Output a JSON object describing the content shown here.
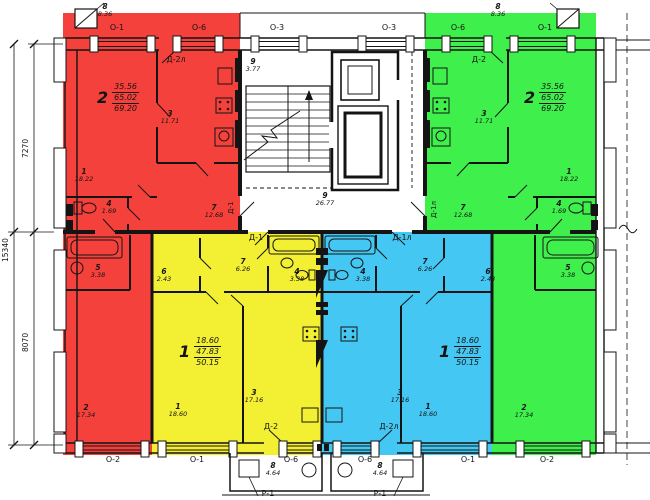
{
  "colors": {
    "red": "#f5413b",
    "green": "#3ff04c",
    "yellow": "#f3ef33",
    "blue": "#45c7f3"
  },
  "dimensions": {
    "height_total": "15340",
    "height_top": "7270",
    "height_bottom": "8070"
  },
  "windows_top": [
    "О-1",
    "О-6",
    "О-3",
    "О-3",
    "О-6",
    "О-1"
  ],
  "windows_bottom": [
    "О-2",
    "О-1",
    "О-6",
    "О-6",
    "О-1",
    "О-2"
  ],
  "doors": {
    "red_balcony": "Д-2л",
    "green_balcony": "Д-2",
    "red_entry": "Д-1",
    "green_entry": "Д-1л",
    "yellow_entry": "Д-1",
    "blue_entry": "Д-1л",
    "yellow_balcony": "Д-2",
    "blue_balcony": "Д-2л"
  },
  "porches": {
    "left": "Р-1",
    "right": "Р-1"
  },
  "balconies": {
    "top_left": {
      "num": "8",
      "area": "8.36"
    },
    "top_right": {
      "num": "8",
      "area": "8.36"
    },
    "bottom_left": {
      "num": "8",
      "area": "4.64"
    },
    "bottom_right": {
      "num": "8",
      "area": "4.64"
    }
  },
  "core": {
    "stair": {
      "num": "9",
      "area": "3.77"
    },
    "hall": {
      "num": "9",
      "area": "26.77"
    }
  },
  "apartments": {
    "red": {
      "unit": "2",
      "living": "35.56",
      "total": "65.02",
      "with_balcony": "69.20",
      "rooms": {
        "r1": {
          "num": "1",
          "area": "18.22"
        },
        "r3": {
          "num": "3",
          "area": "11.71"
        },
        "r4": {
          "num": "4",
          "area": "1.69"
        },
        "r5": {
          "num": "5",
          "area": "3.38"
        },
        "r7": {
          "num": "7",
          "area": "12.68"
        },
        "r2": {
          "num": "2",
          "area": "17.34"
        }
      }
    },
    "green": {
      "unit": "2",
      "living": "35.56",
      "total": "65.02",
      "with_balcony": "69.20",
      "rooms": {
        "r1": {
          "num": "1",
          "area": "18.22"
        },
        "r3": {
          "num": "3",
          "area": "11.71"
        },
        "r4": {
          "num": "4",
          "area": "1.69"
        },
        "r5": {
          "num": "5",
          "area": "3.38"
        },
        "r7": {
          "num": "7",
          "area": "12.68"
        },
        "r2": {
          "num": "2",
          "area": "17.34"
        }
      }
    },
    "yellow": {
      "unit": "1",
      "living": "18.60",
      "total": "47.83",
      "with_balcony": "50.15",
      "rooms": {
        "r1": {
          "num": "1",
          "area": "18.60"
        },
        "r3": {
          "num": "3",
          "area": "17.16"
        },
        "r4": {
          "num": "4",
          "area": "3.38"
        },
        "r6": {
          "num": "6",
          "area": "2.43"
        },
        "r7": {
          "num": "7",
          "area": "6.26"
        }
      }
    },
    "blue": {
      "unit": "1",
      "living": "18.60",
      "total": "47.83",
      "with_balcony": "50.15",
      "rooms": {
        "r1": {
          "num": "1",
          "area": "18.60"
        },
        "r3": {
          "num": "3",
          "area": "17.16"
        },
        "r4": {
          "num": "4",
          "area": "3.38"
        },
        "r6": {
          "num": "6",
          "area": "2.43"
        },
        "r7": {
          "num": "7",
          "area": "6.26"
        }
      }
    }
  }
}
